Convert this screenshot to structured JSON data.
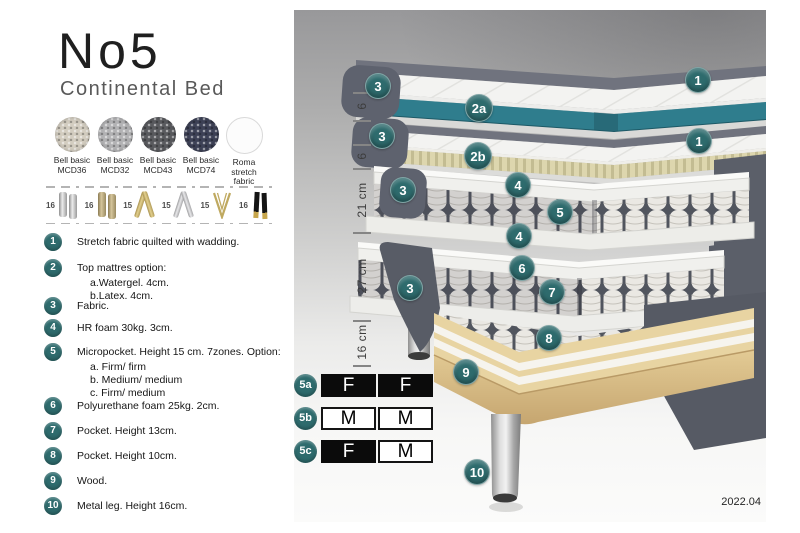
{
  "header": {
    "title": "No5",
    "subtitle": "Continental Bed"
  },
  "swatches": [
    {
      "line1": "Bell basic",
      "line2": "MCD36",
      "color": "#d3cdc0"
    },
    {
      "line1": "Bell basic",
      "line2": "MCD32",
      "color": "#b2b2b4"
    },
    {
      "line1": "Bell basic",
      "line2": "MCD43",
      "color": "#595a5e"
    },
    {
      "line1": "Bell basic",
      "line2": "MCD74",
      "color": "#3d4156"
    },
    {
      "line1": "Roma",
      "line2": "stretch fabric",
      "color": "#fcfcfc"
    }
  ],
  "legs": [
    {
      "height": "16",
      "style": "cylinder-silver"
    },
    {
      "height": "16",
      "style": "cylinder-brass"
    },
    {
      "height": "15",
      "style": "cross-gold"
    },
    {
      "height": "15",
      "style": "cross-silver"
    },
    {
      "height": "15",
      "style": "hairpin-gold"
    },
    {
      "height": "16",
      "style": "tapered-black-gold"
    }
  ],
  "features": [
    {
      "num": "1",
      "text": "Stretch fabric quilted with wadding.",
      "subs": []
    },
    {
      "num": "2",
      "text": "Top mattres option:",
      "subs": [
        "a.Watergel. 4cm.",
        "b.Latex. 4cm."
      ]
    },
    {
      "num": "3",
      "text": "Fabric.",
      "subs": []
    },
    {
      "num": "4",
      "text": "HR foam 30kg. 3cm.",
      "subs": []
    },
    {
      "num": "5",
      "text": "Micropocket. Height 15 cm. 7zones. Option:",
      "subs": [
        "a. Firm/ firm",
        "b. Medium/ medium",
        "c. Firm/ medium"
      ]
    },
    {
      "num": "6",
      "text": "Polyurethane foam 25kg. 2cm.",
      "subs": []
    },
    {
      "num": "7",
      "text": "Pocket. Height 13cm.",
      "subs": []
    },
    {
      "num": "8",
      "text": "Pocket. Height 10cm.",
      "subs": []
    },
    {
      "num": "9",
      "text": "Wood.",
      "subs": []
    },
    {
      "num": "10",
      "text": "Metal leg. Height 16cm.",
      "subs": []
    }
  ],
  "diagram": {
    "ruler_labels": [
      "6",
      "6",
      "21 cm",
      "27 cm",
      "16 cm"
    ],
    "callouts": [
      {
        "label": "3"
      },
      {
        "label": "2a"
      },
      {
        "label": "1"
      },
      {
        "label": "3"
      },
      {
        "label": "2b"
      },
      {
        "label": "1"
      },
      {
        "label": "4"
      },
      {
        "label": "5"
      },
      {
        "label": "3"
      },
      {
        "label": "4"
      },
      {
        "label": "6"
      },
      {
        "label": "7"
      },
      {
        "label": "3"
      },
      {
        "label": "8"
      },
      {
        "label": "9"
      },
      {
        "label": "10"
      }
    ],
    "firmness_rows": [
      {
        "id": "5a",
        "cells": [
          {
            "text": "F",
            "variant": "dark"
          },
          {
            "text": "F",
            "variant": "dark"
          }
        ]
      },
      {
        "id": "5b",
        "cells": [
          {
            "text": "M",
            "variant": "light"
          },
          {
            "text": "M",
            "variant": "light"
          }
        ]
      },
      {
        "id": "5c",
        "cells": [
          {
            "text": "F",
            "variant": "dark"
          },
          {
            "text": "M",
            "variant": "light"
          }
        ]
      }
    ],
    "version": "2022.04"
  },
  "colors": {
    "accent_teal": "#2e6b6d",
    "watergel_teal": "#2f7d8d",
    "fabric_gray": "#5e626e",
    "latex_cream": "#ddd6ae",
    "wood": "#e8d4a2"
  }
}
